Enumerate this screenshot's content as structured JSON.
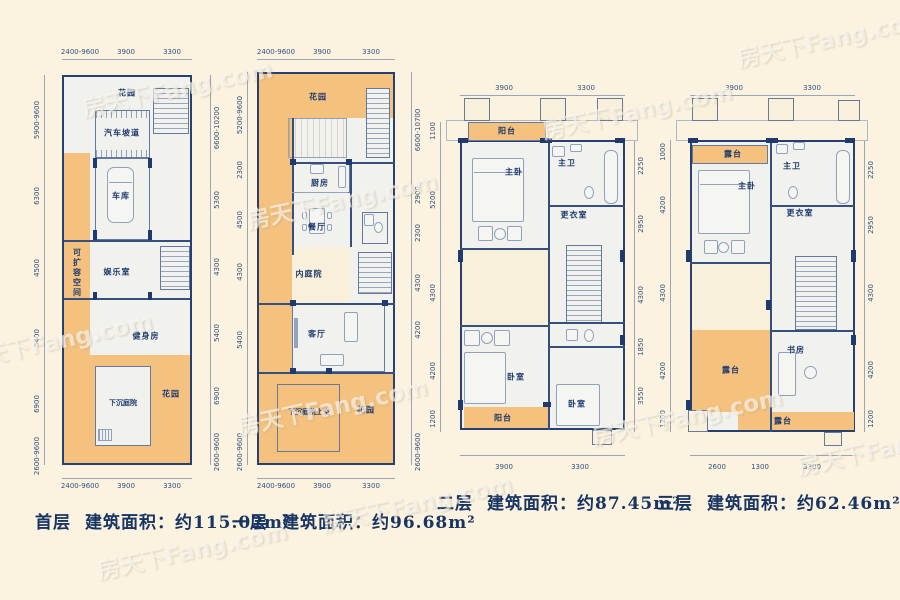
{
  "watermark": {
    "text": "房天下Fang.com"
  },
  "colors": {
    "background": "#fbf3e0",
    "floor": "#f1f2ee",
    "outdoor_orange": "#f4c17e",
    "wall_navy": "#1f3a6d",
    "line_blue": "#8fa1bd",
    "text_navy": "#1d3a6e"
  },
  "plans": [
    {
      "name": "首层",
      "area_text": "建筑面积：约115.02m²",
      "rooms": {
        "garden_top": "花园",
        "car_ramp": "汽车坡道",
        "garage": "车库",
        "expandable": "可扩容空间",
        "recreation": "娱乐室",
        "gym": "健身房",
        "sunken_courtyard": "下沉庭院",
        "garden_bottom": "花园"
      },
      "dims_top": [
        "2400-9600",
        "3900",
        "3300"
      ],
      "dims_bottom": [
        "2400-9600",
        "3900",
        "3300"
      ],
      "dims_left": [
        "5900-9600",
        "6300",
        "4500",
        "5400",
        "6900",
        "2600-9600"
      ],
      "dims_right": [
        "6600-10200",
        "5300",
        "4300",
        "5400",
        "6900",
        "2600-9600"
      ]
    },
    {
      "name": "一层",
      "area_text": "建筑面积：约96.68m²",
      "rooms": {
        "garden_top": "花园",
        "kitchen": "厨房",
        "dining": "餐厅",
        "inner_courtyard": "内庭院",
        "living": "客厅",
        "courtyard_above": "下沉庭院上空",
        "garden_bottom": "花园"
      },
      "dims_top": [
        "2400-9600",
        "3900",
        "3300"
      ],
      "dims_bottom": [
        "2400-9600",
        "3900",
        "3300"
      ],
      "dims_left": [
        "5200-9600",
        "2300",
        "4500",
        "4300",
        "5400",
        "2600-9600"
      ],
      "dims_right": [
        "6600-10700",
        "2900",
        "2300",
        "4300",
        "4200",
        "2600-9600"
      ]
    },
    {
      "name": "二层",
      "area_text": "建筑面积：约87.45m²",
      "rooms": {
        "balcony_top": "阳台",
        "master_bedroom": "主卧",
        "master_bath": "主卫",
        "dressing": "更衣室",
        "bedroom_left": "卧室",
        "bedroom_right": "卧室",
        "balcony_bottom": "阳台"
      },
      "dims_top": [
        "3900",
        "3300"
      ],
      "dims_bottom": [
        "3900",
        "3300"
      ],
      "dims_left": [
        "1100",
        "5200",
        "4300",
        "4200",
        "1200"
      ],
      "dims_right": [
        "2250",
        "2950",
        "4300",
        "1850",
        "3550"
      ]
    },
    {
      "name": "三层",
      "area_text": "建筑面积：约62.46m²",
      "rooms": {
        "terrace_top": "露台",
        "master_bedroom": "主卧",
        "master_bath": "主卫",
        "dressing": "更衣室",
        "terrace_mid": "露台",
        "study": "书房",
        "terrace_bottom": "露台"
      },
      "dims_top": [
        "3900",
        "3300"
      ],
      "dims_bottom": [
        "2600",
        "1300",
        "3300"
      ],
      "dims_left": [
        "1000",
        "4200",
        "4300",
        "4200",
        "1200"
      ],
      "dims_right": [
        "2250",
        "2950",
        "4300",
        "4200",
        "1200"
      ]
    }
  ]
}
